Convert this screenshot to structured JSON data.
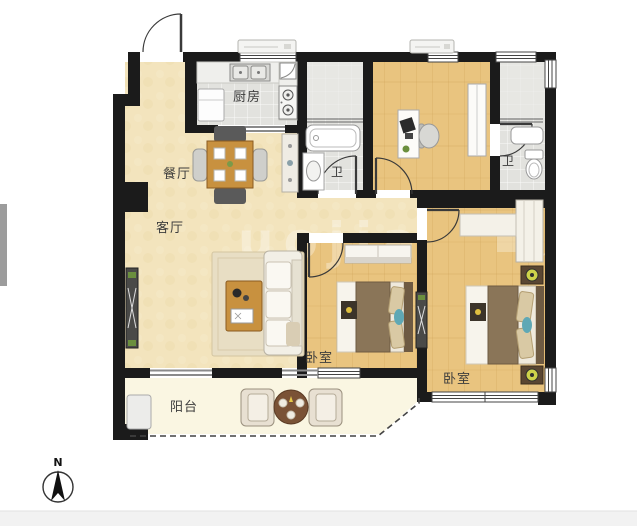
{
  "labels": {
    "kitchen": "厨房",
    "dining": "餐厅",
    "living": "客厅",
    "bath_left": "卫",
    "bath_right": "卫",
    "bedroom_mid": "卧室",
    "bedroom_right": "卧室",
    "balcony": "阳台"
  },
  "compass": {
    "north": "N"
  },
  "watermark": {
    "main": "uojia",
    "small": "om"
  },
  "colors": {
    "wall": "#1b1b1b",
    "living_floor": "#f3e4bd",
    "wood_floor": "#e9c47f",
    "tile_floor": "#e2e2de",
    "balcony_floor": "#faf6e2",
    "table_wood": "#c8913f",
    "accent_teal": "#5fa8b5",
    "lamp_green": "#cdd24a",
    "sidebar_gray": "#9c9c9c",
    "footer_gray": "#f2f2f2"
  }
}
